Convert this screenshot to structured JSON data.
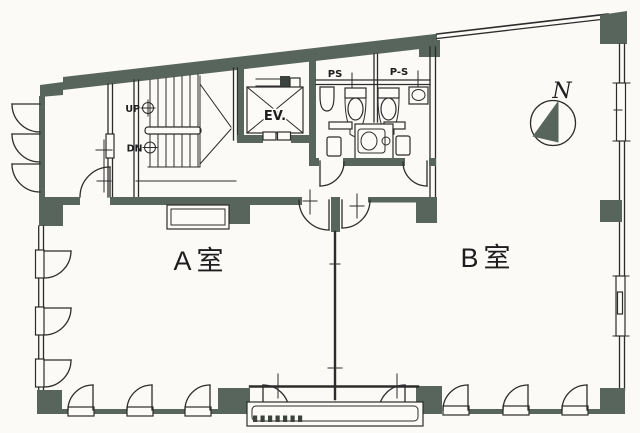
{
  "meta": {
    "type": "scanned architectural floor plan",
    "width_px": 640,
    "height_px": 433
  },
  "rooms": {
    "room_a": {
      "label": "A室"
    },
    "room_b": {
      "label": "B室"
    }
  },
  "stairwell": {
    "up_label": "UP",
    "down_label": "DN"
  },
  "elevator": {
    "label": "EV."
  },
  "pipe_spaces": {
    "left_label": "PS",
    "right_label": "P-S"
  },
  "compass": {
    "north_label": "N"
  },
  "colors": {
    "wall_fill": "#57655d",
    "line": "#2c2c2c",
    "background": "#fbfaf7"
  }
}
